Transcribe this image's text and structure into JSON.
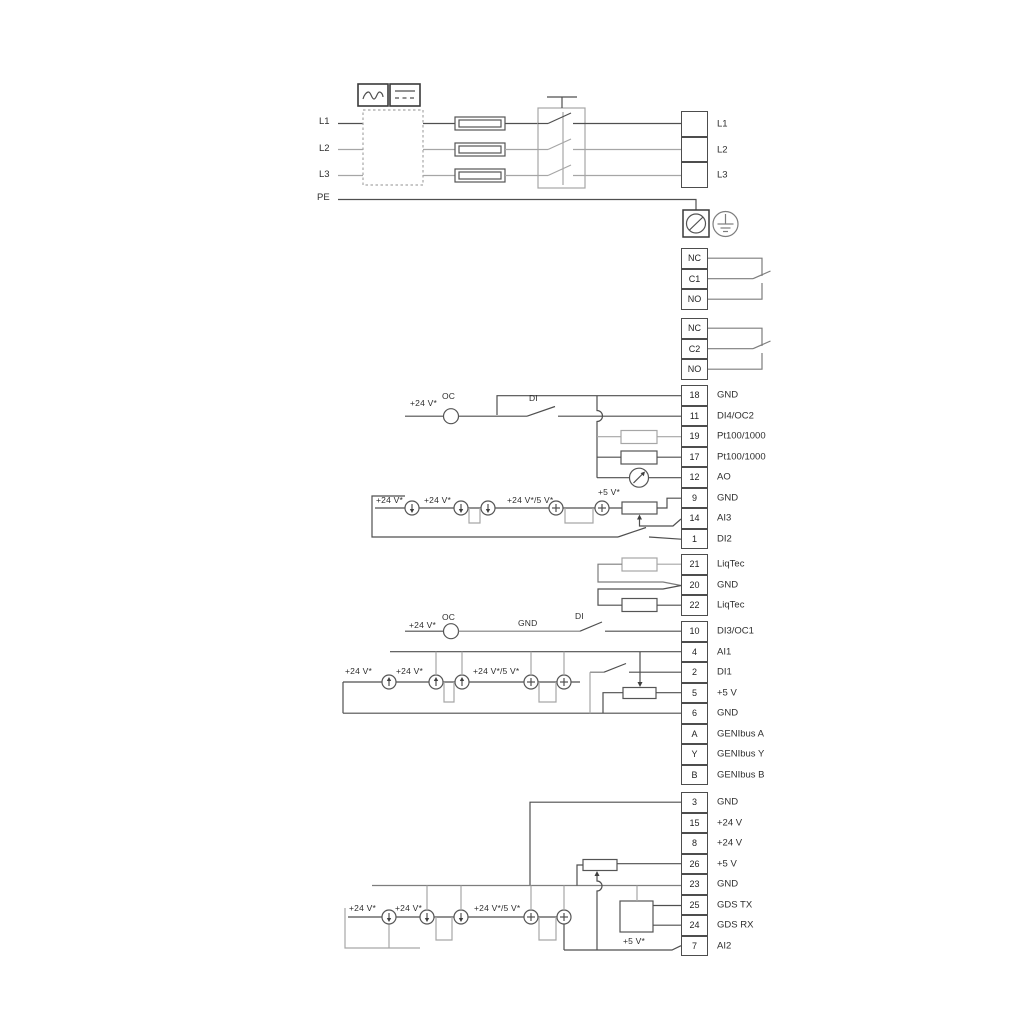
{
  "power": {
    "phase_labels": [
      "L1",
      "L2",
      "L3"
    ],
    "pe_label": "PE",
    "output_terminals": [
      "L1",
      "L2",
      "L3"
    ]
  },
  "relays": [
    {
      "rows": [
        {
          "t": "NC"
        },
        {
          "t": "C1"
        },
        {
          "t": "NO"
        }
      ]
    },
    {
      "rows": [
        {
          "t": "NC"
        },
        {
          "t": "C2"
        },
        {
          "t": "NO"
        }
      ]
    }
  ],
  "io1": {
    "rows": [
      {
        "n": "18",
        "l": "GND"
      },
      {
        "n": "11",
        "l": "DI4/OC2"
      },
      {
        "n": "19",
        "l": "Pt100/1000"
      },
      {
        "n": "17",
        "l": "Pt100/1000"
      },
      {
        "n": "12",
        "l": "AO"
      },
      {
        "n": "9",
        "l": "GND"
      },
      {
        "n": "14",
        "l": "AI3"
      },
      {
        "n": "1",
        "l": "DI2"
      }
    ]
  },
  "liqtec": {
    "rows": [
      {
        "n": "21",
        "l": "LiqTec"
      },
      {
        "n": "20",
        "l": "GND"
      },
      {
        "n": "22",
        "l": "LiqTec"
      }
    ]
  },
  "io2": {
    "rows": [
      {
        "n": "10",
        "l": "DI3/OC1"
      },
      {
        "n": "4",
        "l": "AI1"
      },
      {
        "n": "2",
        "l": "DI1"
      },
      {
        "n": "5",
        "l": "+5 V"
      },
      {
        "n": "6",
        "l": "GND"
      },
      {
        "n": "A",
        "l": "GENIbus A"
      },
      {
        "n": "Y",
        "l": "GENIbus Y"
      },
      {
        "n": "B",
        "l": "GENIbus B"
      }
    ]
  },
  "io3": {
    "rows": [
      {
        "n": "3",
        "l": "GND"
      },
      {
        "n": "15",
        "l": "+24 V"
      },
      {
        "n": "8",
        "l": "+24 V"
      },
      {
        "n": "26",
        "l": "+5 V"
      },
      {
        "n": "23",
        "l": "GND"
      },
      {
        "n": "25",
        "l": "GDS TX"
      },
      {
        "n": "24",
        "l": "GDS RX"
      },
      {
        "n": "7",
        "l": "AI2"
      }
    ]
  },
  "labels": {
    "plus24": "+24 V*",
    "plus24or5": "+24 V*/5 V*",
    "plus5": "+5 V*",
    "oc": "OC",
    "di": "DI",
    "gnd": "GND"
  },
  "colors": {
    "wire_dark": "#4f4f4f",
    "wire_gray": "#a6a6a6",
    "text": "#2e2e2e"
  }
}
